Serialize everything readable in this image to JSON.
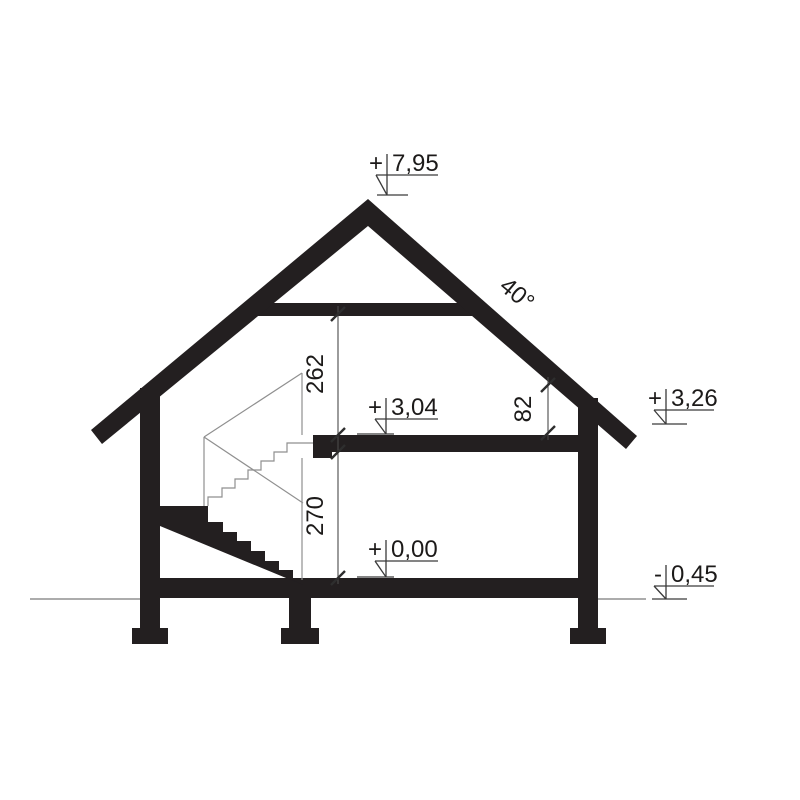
{
  "meta": {
    "description": "Architectural house cross-section drawing with level marks and vertical dimensions"
  },
  "palette": {
    "ink": "#231f20",
    "thin_line": "#8f8f8f",
    "background": "#ffffff"
  },
  "roof": {
    "angle_label": "40°"
  },
  "levels": {
    "ridge": {
      "sign": "+",
      "value": "7,95"
    },
    "attic_floor": {
      "sign": "+",
      "value": "3,04"
    },
    "eave": {
      "sign": "+",
      "value": "3,26"
    },
    "ground_floor": {
      "sign": "+",
      "value": "0,00"
    },
    "terrain": {
      "sign": "-",
      "value": "0,45"
    }
  },
  "dimensions": {
    "attic_room_height": "262",
    "ground_room_height": "270",
    "knee_wall_height": "82"
  }
}
